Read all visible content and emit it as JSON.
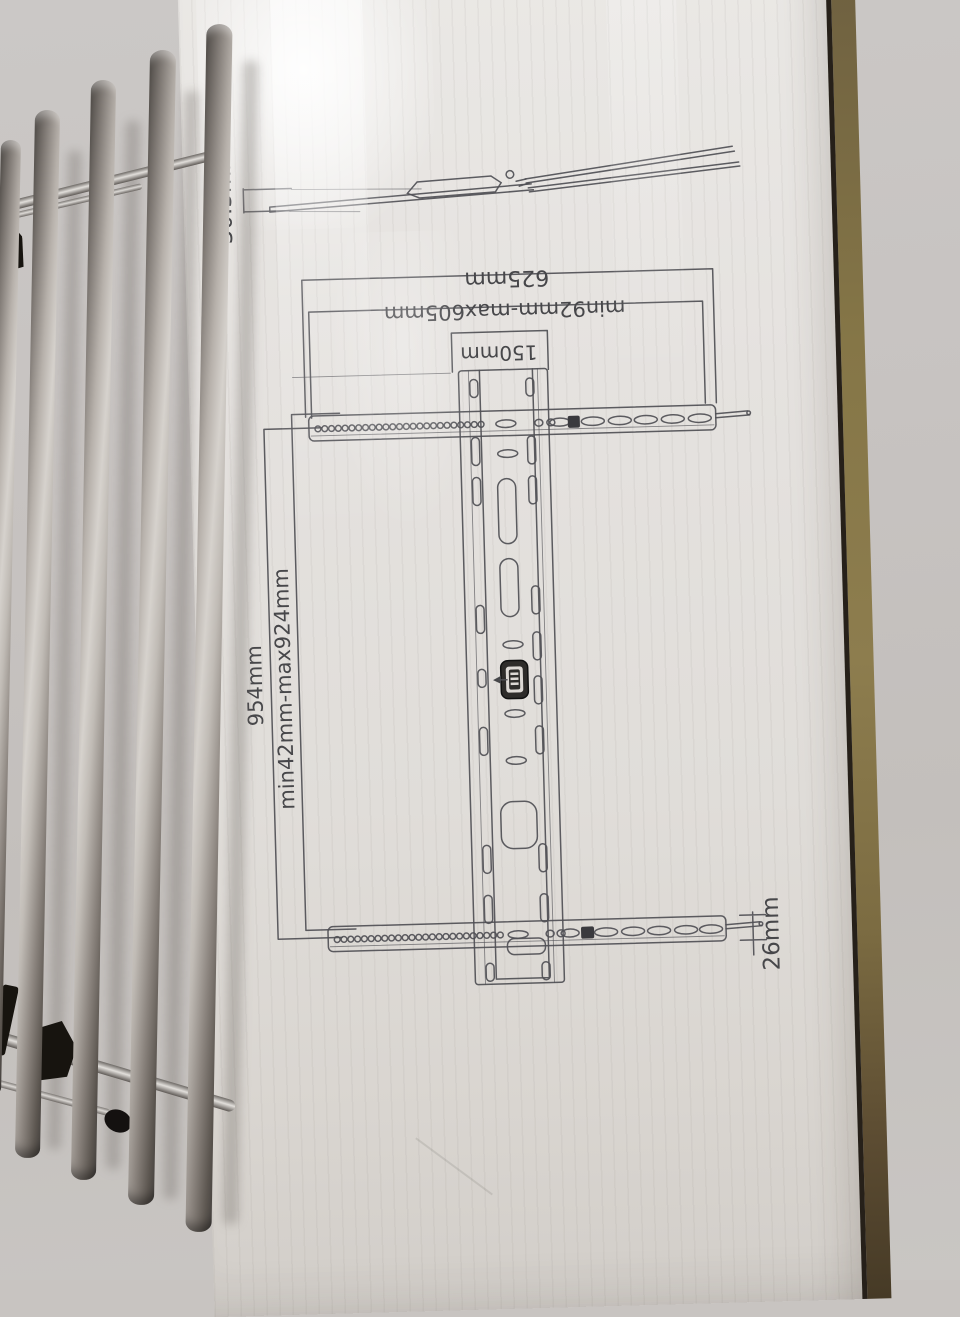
{
  "diagram": {
    "labels": {
      "depth": "30.5mm",
      "total_width": "625mm",
      "width_range": "min92mm-max605mm",
      "center_width": "150mm",
      "total_height": "954mm",
      "height_range": "min42mm-max924mm",
      "rail_thickness": "26mm"
    }
  },
  "colors": {
    "wall_left": "#c8c4c1",
    "wall_right": "#b2a7a5",
    "box_face": "#e5e2df",
    "cardboard_edge": "#857548",
    "print_line": "#505055",
    "metal_highlight": "#d6d2cd",
    "metal_shadow": "#4e4a46",
    "clip_black": "#17140f"
  }
}
